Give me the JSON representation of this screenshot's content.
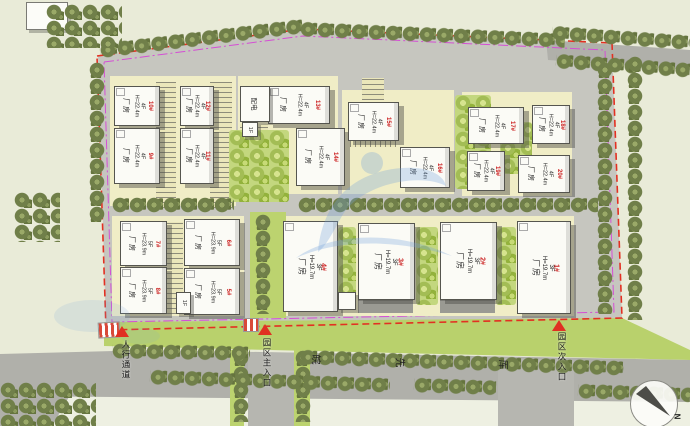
{
  "buildings": [
    {
      "name": "厂房",
      "floors": "4F",
      "height": "H=22.4m",
      "num": "10#"
    },
    {
      "name": "厂房",
      "floors": "4F",
      "height": "H=22.4m",
      "num": "9#"
    },
    {
      "name": "厂房",
      "floors": "4F",
      "height": "H=22.4m",
      "num": "12#"
    },
    {
      "name": "厂房",
      "floors": "4F",
      "height": "H=22.4m",
      "num": "11#"
    },
    {
      "name": "厂房",
      "floors": "4F",
      "height": "H=22.4m",
      "num": "13#"
    },
    {
      "name": "厂房",
      "floors": "4F",
      "height": "H=22.4m",
      "num": "14#"
    },
    {
      "name": "厂房",
      "floors": "4F",
      "height": "H=22.4m",
      "num": "15#"
    },
    {
      "name": "厂房",
      "floors": "4F",
      "height": "H=22.4m",
      "num": "16#"
    },
    {
      "name": "厂房",
      "floors": "4F",
      "height": "H=22.4m",
      "num": "17#"
    },
    {
      "name": "厂房",
      "floors": "4F",
      "height": "H=22.4m",
      "num": "18#"
    },
    {
      "name": "厂房",
      "floors": "4F",
      "height": "H=22.4m",
      "num": "19#"
    },
    {
      "name": "厂房",
      "floors": "4F",
      "height": "H=22.4m",
      "num": "20#"
    },
    {
      "name": "厂房",
      "floors": "5F",
      "height": "H=23.9m",
      "num": "7#"
    },
    {
      "name": "厂房",
      "floors": "5F",
      "height": "H=23.9m",
      "num": "6#"
    },
    {
      "name": "厂房",
      "floors": "5F",
      "height": "H=23.9m",
      "num": "8#"
    },
    {
      "name": "厂房",
      "floors": "5F",
      "height": "H=23.9m",
      "num": "5#"
    },
    {
      "name": "厂房",
      "floors": "3F",
      "height": "H=19.7m",
      "num": "4#"
    },
    {
      "name": "厂房",
      "floors": "3F",
      "height": "H=19.7m",
      "num": "3#"
    },
    {
      "name": "厂房",
      "floors": "3F",
      "height": "H=19.7m",
      "num": "2#"
    },
    {
      "name": "厂房",
      "floors": "3F",
      "height": "H=19.7m",
      "num": "1#"
    }
  ],
  "substation": {
    "name": "配电",
    "floor": "1F"
  },
  "annex": {
    "floor": "1F"
  },
  "entrances": {
    "pedestrian": "人行通道",
    "main": "园区主入口",
    "secondary": "园区次入口"
  },
  "road_label": {
    "chars": [
      "皖",
      "先",
      "厍"
    ]
  },
  "compass": {
    "north": "N"
  },
  "colors": {
    "boundary_red": "#e33022",
    "control_magenta": "#d44fd4",
    "label_red": "#cc2222",
    "road_gray": "#b0b0aa",
    "lawn_green": "#b9d16c",
    "tree_dark": "#707f49",
    "tree_bright": "#a3bd55",
    "apron_cream": "#f0edc6",
    "building_white": "#fbfbf6"
  }
}
